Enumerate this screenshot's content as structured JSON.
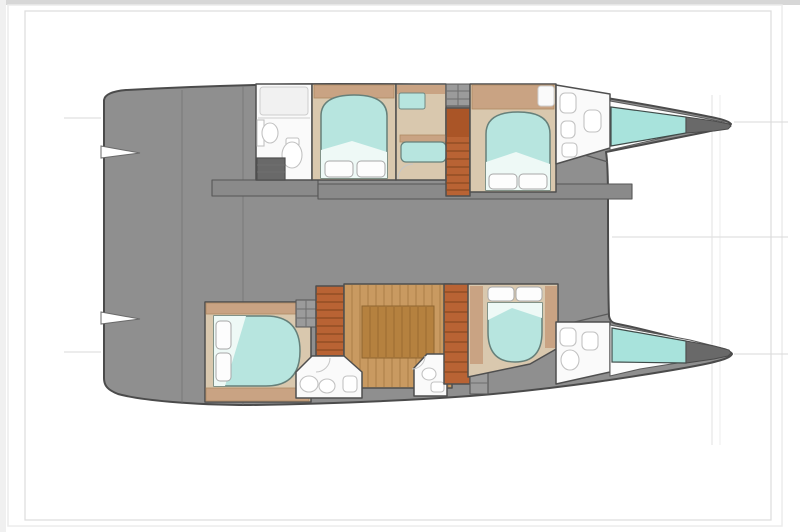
{
  "vessel": {
    "type": "catamaran yacht floor plan",
    "view": "top-down deck plan",
    "orientation": "bows pointing right, twin hulls joined by bridge deck",
    "counts": {
      "double_beds": 4,
      "bathrooms": 5,
      "staircases": 3,
      "bow_lockers": 2
    }
  },
  "port_hull_top": {
    "rooms": [
      "aft bathroom with shower, sink and toilet",
      "aft double cabin",
      "settee and vanity area",
      "companionway stairs",
      "forward double cabin",
      "forward bathroom",
      "teal bow locker"
    ]
  },
  "starboard_hull_bottom": {
    "rooms": [
      "aft double cabin with side pillows",
      "aft bathroom",
      "aft companionway stairs",
      "wood floor galley area",
      "mid bathroom",
      "forward companionway stairs",
      "forward double cabin",
      "forward bathroom",
      "teal bow locker"
    ]
  },
  "colors": {
    "background": "#ffffff",
    "frame_band": "#d7d7d7",
    "frame_edge": "#ececec",
    "frame_line": "#dcdcdc",
    "hull": "#8f8f8f",
    "hull_outline": "#4b4b4b",
    "walkway": "#8a8a8a",
    "floor_beige": "#d9c8ae",
    "cabinet_tan": "#c9a383",
    "bed_aqua": "#b7e5df",
    "bed_sheet": "#eef9f6",
    "pillow": "#fdfdfd",
    "stairs_orange": "#b96334",
    "stairs_landing": "#aa5527",
    "wood_light": "#c99a61",
    "wood_dark": "#b5813f",
    "bathroom_white": "#fafafa",
    "hatch_gray": "#9b9b9b",
    "bow_teal": "#a8e3dc",
    "bow_tip": "#696969",
    "bow_void": "#fcfcfc",
    "notch_white": "#ffffff"
  }
}
